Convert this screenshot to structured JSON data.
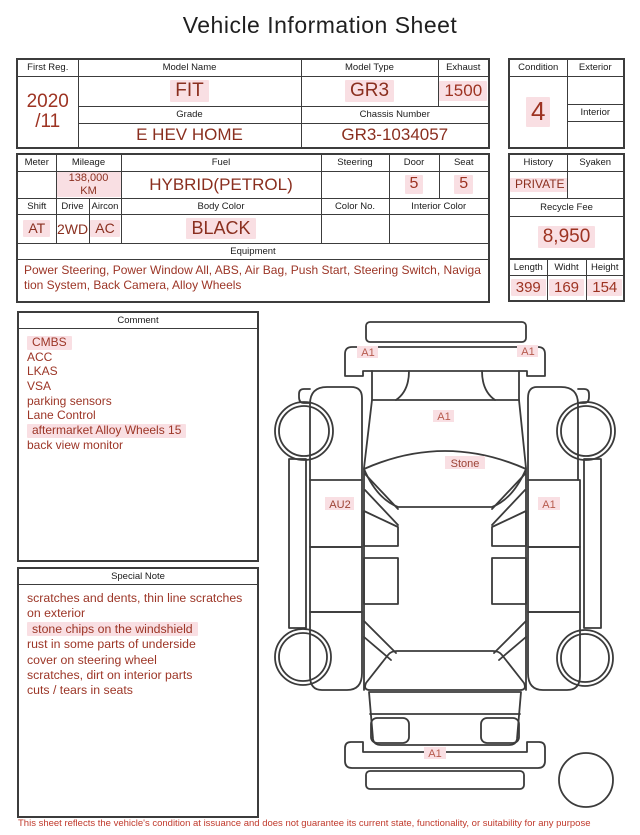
{
  "title": "Vehicle Information Sheet",
  "table1": {
    "first_reg_label": "First Reg.",
    "first_reg_year": "2020",
    "first_reg_month": "/11",
    "model_name_label": "Model Name",
    "model_name": "FIT",
    "model_type_label": "Model Type",
    "model_type": "GR3",
    "exhaust_label": "Exhaust",
    "exhaust": "1500",
    "grade_label": "Grade",
    "grade": "E HEV HOME",
    "chassis_label": "Chassis Number",
    "chassis": "GR3-1034057"
  },
  "condition_box": {
    "condition_label": "Condition",
    "condition": "4",
    "exterior_label": "Exterior",
    "interior_label": "Interior"
  },
  "table2": {
    "meter_label": "Meter",
    "mileage_label": "Mileage",
    "mileage": "138,000 KM",
    "fuel_label": "Fuel",
    "fuel": "HYBRID(PETROL)",
    "steering_label": "Steering",
    "door_label": "Door",
    "door": "5",
    "seat_label": "Seat",
    "seat": "5",
    "shift_label": "Shift",
    "shift": "AT",
    "drive_label": "Drive",
    "drive": "2WD",
    "aircon_label": "Aircon",
    "aircon": "AC",
    "body_color_label": "Body Color",
    "body_color": "BLACK",
    "color_no_label": "Color No.",
    "interior_color_label": "Interior Color",
    "equipment_label": "Equipment",
    "equipment": "Power Steering, Power Window All, ABS, Air Bag, Push Start, Steering Switch, Navigation System, Back Camera, Alloy Wheels"
  },
  "history_box": {
    "history_label": "History",
    "history": "PRIVATE",
    "syaken_label": "Syaken",
    "recycle_fee_label": "Recycle Fee",
    "recycle_fee": "8,950",
    "length_label": "Length",
    "width_label": "Widht",
    "height_label": "Height",
    "length": "399",
    "width": "169",
    "height": "154"
  },
  "comment": {
    "label": "Comment",
    "items": [
      "CMBS",
      "ACC",
      "LKAS",
      "VSA",
      "parking sensors",
      "Lane Control",
      "aftermarket Alloy Wheels 15",
      "back view monitor"
    ]
  },
  "special_note": {
    "label": "Special Note",
    "items": [
      "scratches and dents, thin line scratches on exterior",
      "stone chips on the windshield",
      "rust in some parts of underside",
      "cover on steering wheel",
      "scratches, dirt on interior parts",
      "cuts / tears in seats"
    ]
  },
  "diagram": {
    "labels": {
      "front_left": "A1",
      "front_right": "A1",
      "hood": "A1",
      "windshield": "Stone",
      "side_left": "AU2",
      "side_right": "A1",
      "rear": "A1"
    }
  },
  "footer": {
    "disclaimer": "This sheet reflects the vehicle's condition at issuance and does not guarantee its current state, functionality, or suitability for any purpose"
  },
  "colors": {
    "value_red": "#8a2f1f",
    "number_red": "#9d3322",
    "disclaimer_red": "#c0392b",
    "highlight_pink": "#f9dfe3",
    "line_gray": "#3b3b3b"
  }
}
